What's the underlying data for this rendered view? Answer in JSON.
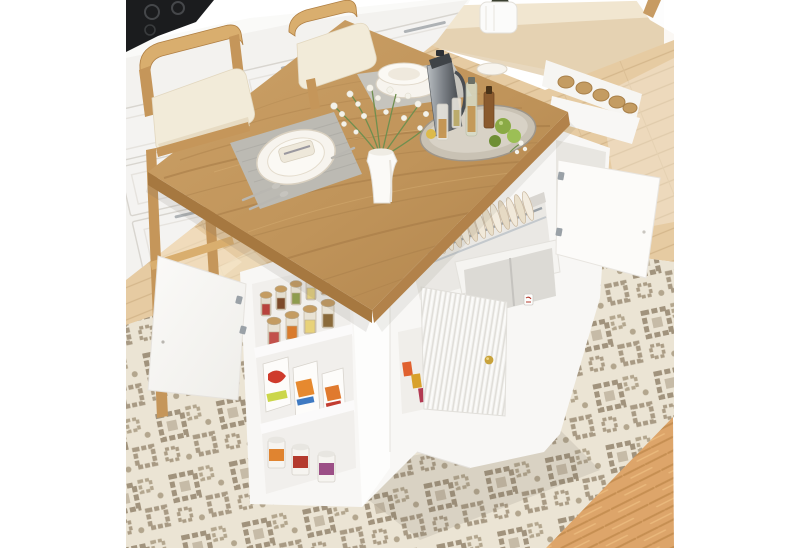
{
  "scene": {
    "type": "furniture-product-photo",
    "subject": "drop-leaf kitchen island dining table with open storage",
    "elements": [
      "natural wood tabletop with grain",
      "white island base with open shelves",
      "spice jars with wooden lids on top shelf",
      "cereal boxes on middle shelf",
      "food cans on bottom shelf",
      "dish rack with plates inside center cabinet",
      "open white cabinet doors left and right",
      "fluted door with gold knob",
      "open drawer with cup inside",
      "two wooden bar chairs with cream cushions",
      "white kitchen cabinets with black cooktop",
      "gray placemats with plates and cutlery",
      "white vase with flower bouquet",
      "round tray with pitcher, glasses, bottles and limes",
      "white planter",
      "beige geometric area rug",
      "herringbone wood floor",
      "bright window light"
    ]
  },
  "palette": {
    "photo_bg": "#ffffff",
    "wall_cream": "#f1e6d0",
    "wall_band": "#e0cba8",
    "window_white": "#fdfdfd",
    "window_frame_tan": "#c79b63",
    "counter_white": "#fafaf8",
    "cooktop_black": "#1b1c1e",
    "cabinet_white": "#f3f2ef",
    "cabinet_line": "#d8d5cf",
    "handle_chrome": "#aeb2b5",
    "floor_tan": "#e6cba2",
    "floor_line": "#d5b78c",
    "sun_stripe": "#f7ead0",
    "herringbone": "#dda56a",
    "herringbone_line": "#c68f52",
    "rug_base": "#ebe4d4",
    "rug_motif": "#a1937d",
    "rug_motif_soft": "#c6bba7",
    "chair_wood": "#c5965a",
    "chair_wood_light": "#d9ae6e",
    "cushion_cream": "#f2ebd9",
    "table_wood": "#c0945a",
    "table_grain": "#9d7341",
    "table_edge": "#a67840",
    "island_white": "#f8f7f5",
    "island_bright": "#fdfdfc",
    "island_interior": "#eae8e4",
    "island_deep": "#dcdad5",
    "gold_knob": "#c8a23b",
    "chrome": "#9aa1a7",
    "plate_white": "#f7f4ee",
    "plate_rim": "#d9d0c0",
    "mat_gray": "#bcbab3",
    "pitcher_steel": "#7d8288",
    "amber": "#bf8a3e",
    "lime_green": "#8aaa45",
    "leaf_green": "#6f8f4f",
    "blossom_white": "#f4f2ea",
    "jar_lid": "#c49c62",
    "jar_red": "#b8433d",
    "jar_brown": "#7c4a2a",
    "jar_orange": "#d97b2c",
    "jar_green": "#8f9c4e",
    "box_red": "#cf3b2c",
    "box_orange": "#e6892f",
    "can_purple": "#9c4f86",
    "snack_orange": "#e0612f",
    "shadow": "#6f675a"
  }
}
